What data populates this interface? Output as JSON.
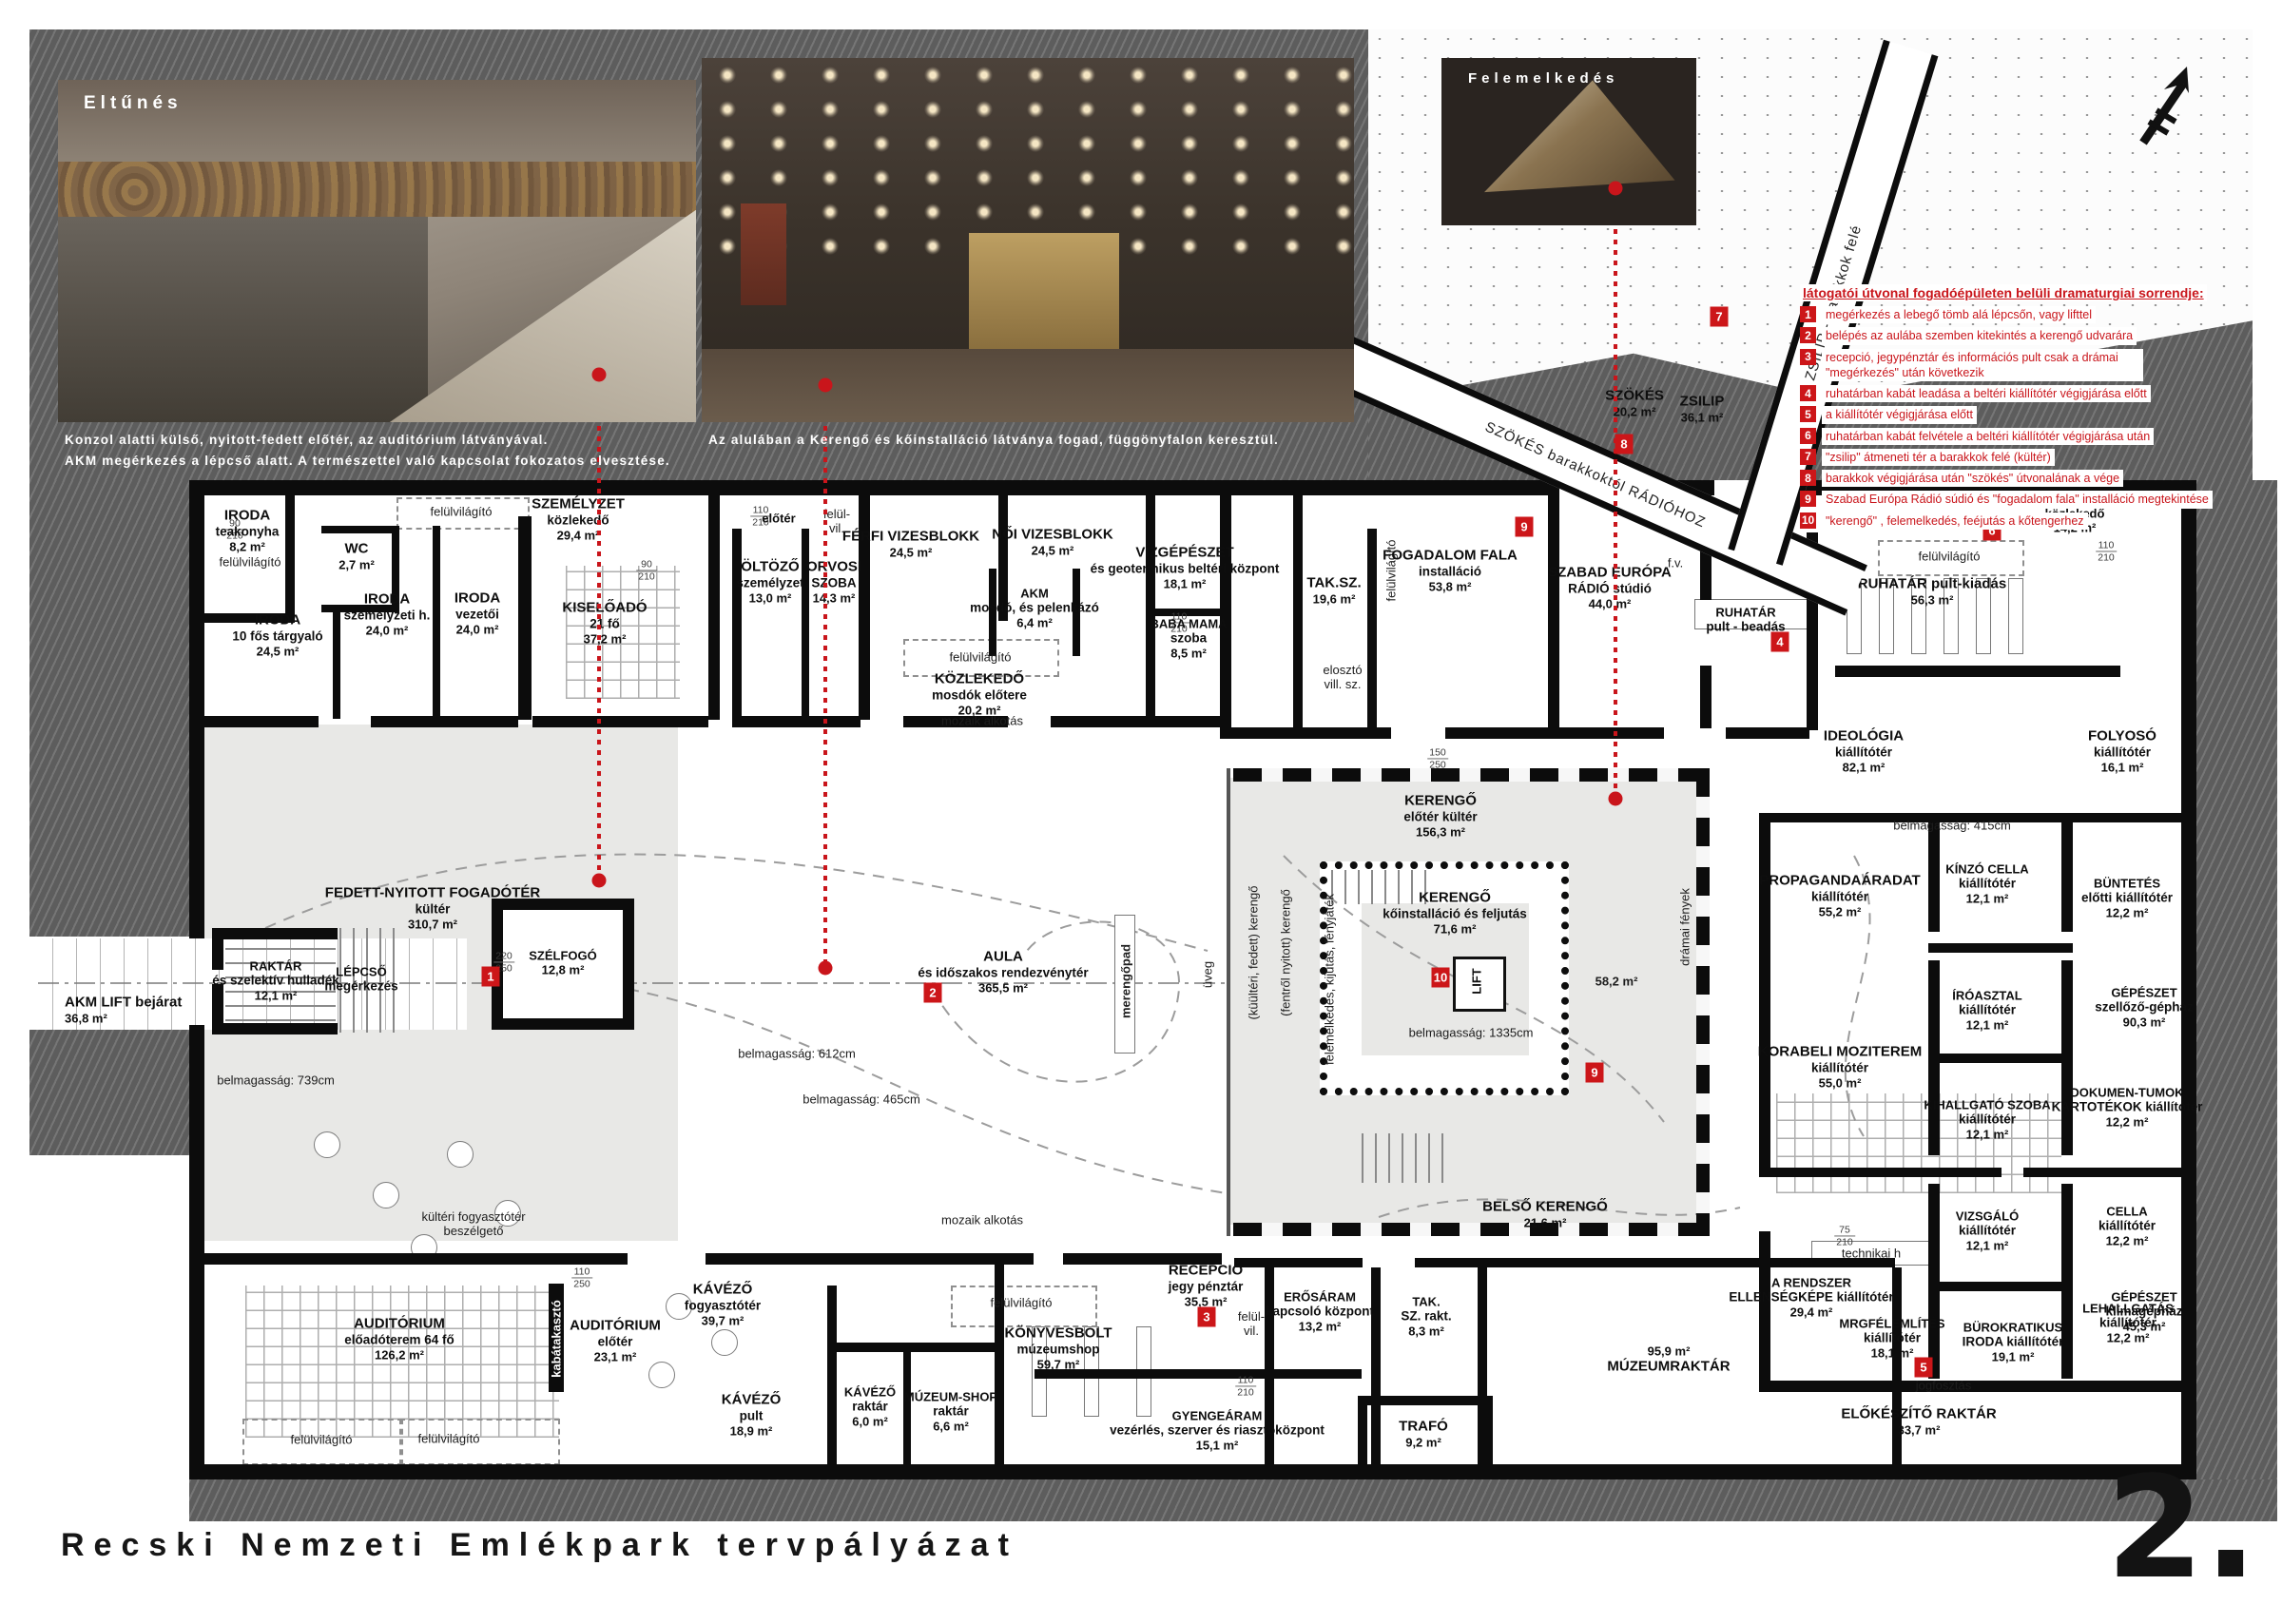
{
  "renders": {
    "r1_tag": "Eltűnés",
    "r1_caption": "Konzol alatti külső, nyitott-fedett előtér, az auditórium látványával.\nAKM megérkezés a lépcső alatt. A természettel való kapcsolat fokozatos elvesztése.",
    "r2_caption": "Az alulában a Kerengő és kőinstalláció látványa fogad, függönyfalon keresztül.",
    "r3_tag": "Felemelkedés"
  },
  "corridors": {
    "szokes": "SZÖKÉS barakkoktól RÁDIÓHOZ",
    "zsilip": "ZSILIP - barakkok felé"
  },
  "route": {
    "title": "látogatói útvonal fogadóépületen belüli dramaturgiai sorrendje:",
    "items": [
      {
        "num": "1",
        "text": "megérkezés a lebegő tömb alá lépcsőn, vagy lifttel"
      },
      {
        "num": "2",
        "text": "belépés az aulába szemben kitekintés a kerengő udvarára"
      },
      {
        "num": "3",
        "text": "recepció, jegypénztár és információs pult csak a drámai \"megérkezés\" után következik"
      },
      {
        "num": "4",
        "text": "ruhatárban kabát leadása a beltéri kiállítótér végigjárása előtt"
      },
      {
        "num": "5",
        "text": "a kiállítótér végigjárása előtt"
      },
      {
        "num": "6",
        "text": "ruhatárban kabát felvétele a beltéri kiállítótér végigjárása után"
      },
      {
        "num": "7",
        "text": "\"zsilip\" átmeneti tér a barakkok felé (kültér)"
      },
      {
        "num": "8",
        "text": "barakkok végigjárása után \"szökés\" útvonalának a vége"
      },
      {
        "num": "9",
        "text": "Szabad Európa Rádió súdió és \"fogadalom fala\" installáció megtekintése"
      },
      {
        "num": "10",
        "text": "\"kerengő\" , felemelkedés, feéjutás a kőtengerhez"
      }
    ]
  },
  "markers": {
    "m1": "1",
    "m2": "2",
    "m3": "3",
    "m4": "4",
    "m5": "5",
    "m6": "6",
    "m7": "7",
    "m8": "8",
    "m9": "9",
    "m10": "10"
  },
  "rooms": {
    "iroda_teakonyha": {
      "n": "IRODA",
      "s": "teakonyha",
      "a": "8,2 m²"
    },
    "wc": {
      "n": "WC",
      "a": "2,7 m²"
    },
    "iroda_targyalo": {
      "n": "IRODA",
      "s": "10 fős tárgyaló",
      "a": "24,5 m²"
    },
    "iroda_szemelyzeti": {
      "n": "IRODA",
      "s": "személyzeti h.",
      "a": "24,0 m²"
    },
    "iroda_vezetoi": {
      "n": "IRODA",
      "s": "vezetői",
      "a": "24,0 m²"
    },
    "szemelyzet_kozlekedo": {
      "n": "SZEMÉLYZET",
      "s": "közlekedő",
      "a": "29,4 m²"
    },
    "kiseloado": {
      "n": "KISELŐADÓ",
      "s": "21 fő",
      "a": "37,2 m²"
    },
    "eloter": {
      "n": "előtér"
    },
    "oltozo": {
      "n": "ÖLTÖZŐ",
      "s": "személyzet",
      "a": "13,0 m²"
    },
    "orvosi": {
      "n": "ORVOSI",
      "s": "SZOBA",
      "a": "14,3 m²"
    },
    "ferfi_vizesblokk": {
      "n": "FÉRFI VIZESBLOKK",
      "a": "24,5 m²"
    },
    "noi_vizesblokk": {
      "n": "NŐI VIZESBLOKK",
      "a": "24,5 m²"
    },
    "akm_mosdo": {
      "n": "AKM",
      "s": "mosdó, és pelenkázó",
      "a": "6,4 m²"
    },
    "vizgepeszet": {
      "n": "VÍZGÉPÉSZET",
      "s": "és geotermikus beltéri központ",
      "a": "18,1 m²"
    },
    "baba_mama": {
      "n": "BABA MAMA",
      "s": "szoba",
      "a": "8,5 m²"
    },
    "kozlekedo_mosdok": {
      "n": "KÖZLEKEDŐ",
      "s": "mosdók előtere",
      "a": "20,2 m²"
    },
    "tak_sz": {
      "n": "TAK.SZ.",
      "a": "19,6 m²"
    },
    "fogadalom_fala": {
      "n": "FOGADALOM FALA",
      "s": "installáció",
      "a": "53,8 m²"
    },
    "szer_radio": {
      "n": "SZABAD EURÓPA",
      "s": "RÁDIÓ stúdió",
      "a": "44,0 m²"
    },
    "ruhatar_beadas": {
      "n": "RUHATÁR",
      "s": "pult - beadás"
    },
    "ruhatar_kiadas": {
      "n": "RUHATÁR pult-kiadás",
      "a": "56,3 m²"
    },
    "kozlekedo_jobb": {
      "n": "közlekedő",
      "a": "14,2 m²"
    },
    "szokes": {
      "n": "SZÖKÉS",
      "a": "20,2 m²"
    },
    "zsilip": {
      "n": "ZSILIP",
      "a": "36,1 m²"
    },
    "ideologia": {
      "n": "IDEOLÓGIA",
      "s": "kiállítótér",
      "a": "82,1 m²"
    },
    "folyoso": {
      "n": "FOLYOSÓ",
      "s": "kiállítótér",
      "a": "16,1 m²"
    },
    "propaganda": {
      "n": "PROPAGANDAÁRADAT",
      "s": "kiállítótér",
      "a": "55,2 m²"
    },
    "kinzo": {
      "n": "KÍNZÓ CELLA",
      "s": "kiállítótér",
      "a": "12,1 m²"
    },
    "buntetes": {
      "n": "BÜNTETÉS",
      "s": "előtti kiállítótér",
      "a": "12,2 m²"
    },
    "gep_szellozo": {
      "n": "GÉPÉSZET",
      "s": "szellőző-gépház",
      "a": "90,3 m²"
    },
    "iroasztal": {
      "n": "ÍRÓASZTAL",
      "s": "kiállítótér",
      "a": "12,1 m²"
    },
    "dokumentumok": {
      "n": "DOKUMEN-TUMOK",
      "s": "KARTOTÉKOK kiállítótér",
      "a": "12,2 m²"
    },
    "korabeli": {
      "n": "KORABELI MOZITEREM",
      "s": "kiállítótér",
      "a": "55,0 m²"
    },
    "kihallgato": {
      "n": "KIHALLGATÓ SZOBA",
      "s": "kiállítótér",
      "a": "12,1 m²"
    },
    "cella": {
      "n": "CELLA",
      "s": "kiállítótér",
      "a": "12,2 m²"
    },
    "gep_klima": {
      "n": "GÉPÉSZET",
      "s": "klímagépház",
      "a": "45,3 m²"
    },
    "vizsgalo": {
      "n": "VIZSGÁLÓ",
      "s": "kiállítótér",
      "a": "12,1 m²"
    },
    "lehallgatas": {
      "n": "LEHALLGATÁS",
      "s": "kiállítótér",
      "a": "12,2 m²"
    },
    "rendszer": {
      "n": "A RENDSZER",
      "s": "ELLENSÉGKÉPE kiállítótér",
      "a": "29,4 m²"
    },
    "megfelemlites": {
      "n": "MRGFÉLEMLÍTÉS",
      "s": "kiállítótér",
      "a": "18,1 m²"
    },
    "burokratikus": {
      "n": "BÜROKRATIKUS",
      "s": "IRODA kiállítótér",
      "a": "19,1 m²"
    },
    "elokeszito": {
      "n": "ELŐKÉSZÍTŐ RAKTÁR",
      "a": "33,7 m²"
    },
    "kerengo_eloter": {
      "n": "KERENGŐ",
      "s": "előtér kültér",
      "a": "156,3 m²"
    },
    "kerengo_ko": {
      "n": "KERENGŐ",
      "s": "kőinstalláció és feljutás",
      "a": "71,6 m²"
    },
    "lift": {
      "n": "LIFT"
    },
    "aula": {
      "n": "AULA",
      "s": "és időszakos rendezvénytér",
      "a": "365,5 m²"
    },
    "szelfogo": {
      "n": "SZÉLFOGÓ",
      "a": "12,8 m²"
    },
    "fogadoter": {
      "n": "FEDETT-NYITOTT FOGADÓTÉR",
      "s": "kültér",
      "a": "310,7 m²"
    },
    "raktar_szelektiv": {
      "n": "RAKTÁR",
      "s": "és szelektív hulladék",
      "a": "12,1 m²"
    },
    "lepcso": {
      "n": "LÉPCSŐ",
      "s": "megérkezés"
    },
    "akm_lift": {
      "n": "AKM LIFT bejárat",
      "a": "36,8 m²"
    },
    "auditorium": {
      "n": "AUDITÓRIUM",
      "s": "előadóterem 64 fő",
      "a": "126,2 m²"
    },
    "auditorium_eloter": {
      "n": "AUDITÓRIUM",
      "s": "előtér",
      "a": "23,1 m²"
    },
    "kavezo_fogyaszto": {
      "n": "KÁVÉZŐ",
      "s": "fogyasztótér",
      "a": "39,7 m²"
    },
    "kavezo_pult": {
      "n": "KÁVÉZŐ",
      "s": "pult",
      "a": "18,9 m²"
    },
    "kavezo_raktar": {
      "n": "KÁVÉZŐ",
      "s": "raktár",
      "a": "6,0 m²"
    },
    "mshop_raktar": {
      "n": "MÚZEUM-SHOP",
      "s": "raktár",
      "a": "6,6 m²"
    },
    "konyvesbolt": {
      "n": "KÖNYVESBOLT",
      "s": "múzeumshop",
      "a": "59,7 m²"
    },
    "recepcio": {
      "n": "RECEPCIÓ",
      "s": "jegy pénztár",
      "a": "35,5 m²"
    },
    "erosaram": {
      "n": "ERŐSÁRAM",
      "s": "kapcsoló központ",
      "a": "13,2 m²"
    },
    "tak_sz_rakt": {
      "n": "TAK.",
      "s": "SZ. rakt.",
      "a": "8,3 m²"
    },
    "muzeumraktar": {
      "n": "MÚZEUMRAKTÁR",
      "a": "95,9 m²"
    },
    "gyengearam": {
      "n": "GYENGEÁRAM",
      "s": "vezérlés, szerver és riasztóközpont",
      "a": "15,1 m²"
    },
    "trafo": {
      "n": "TRAFÓ",
      "a": "9,2 m²"
    },
    "belso_kerengo": {
      "n": "BELSŐ KERENGŐ",
      "a": "21,6 m²"
    }
  },
  "labels": {
    "felulvilagito": "felülvilágító",
    "felul_vil": "felül-\nvil.",
    "mozaik": "mozaik alkotás",
    "kulteri_fogyaszto": "kültéri fogyasztótér\nbeszélgető",
    "kabatakaszto": "kabátakasztó",
    "jogfosztas": "jogfosztás",
    "technikai": "technikai h",
    "fv": "f.v.",
    "eloszto": "elosztó\nvill. sz.",
    "uveg": "üveg",
    "merengopad": "merengőpad",
    "dramai": "drámai fények",
    "m58": "58,2 m²",
    "kerengo_kulteri": "(küültéri, fedett) kerengő",
    "kerengo_fentrol": "(fentről nyitott) kerengő",
    "felemelkedes": "felemelkedés, kijutás, fényjáték",
    "bm739": "belmagasság: 739cm",
    "bm612": "belmagasság: 612cm",
    "bm465": "belmagasság: 465cm",
    "bm415": "belmagasság: 415cm",
    "bm1335": "belmagasság: 1335cm"
  },
  "dims": {
    "n75": "75",
    "n90": "90",
    "n110": "110",
    "n150": "150",
    "n160": "160",
    "n210": "210",
    "n220": "220",
    "n250": "250"
  },
  "footer": {
    "title": "Recski Nemzeti Emlékpark tervpályázat",
    "page": "2."
  }
}
